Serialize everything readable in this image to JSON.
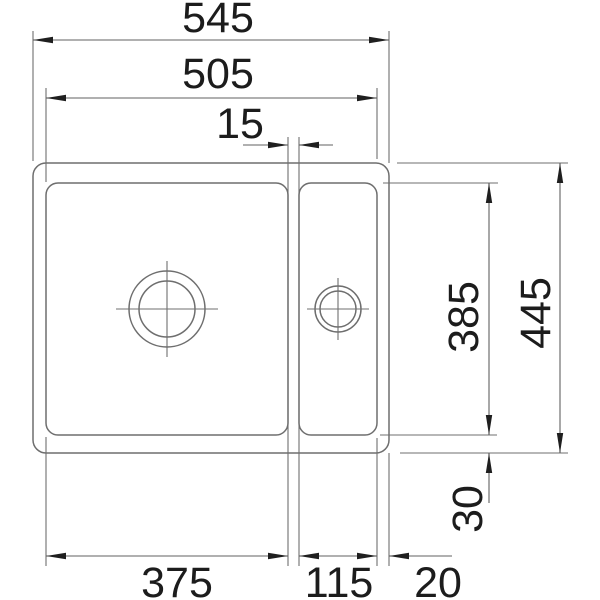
{
  "drawing": {
    "type": "technical-dimension-drawing",
    "subject": "double-bowl sink cutout, top view",
    "background_color": "#ffffff",
    "outline_color": "#6e6e6e",
    "dimension_line_color": "#606060",
    "text_color": "#1c1c1c",
    "labels": {
      "total_width": "545",
      "inner_width": "505",
      "divider_width": "15",
      "inner_depth": "385",
      "total_depth": "445",
      "bottom_rim_offset": "30",
      "main_bowl_width": "375",
      "small_bowl_width": "115",
      "right_rim_offset": "20"
    }
  }
}
